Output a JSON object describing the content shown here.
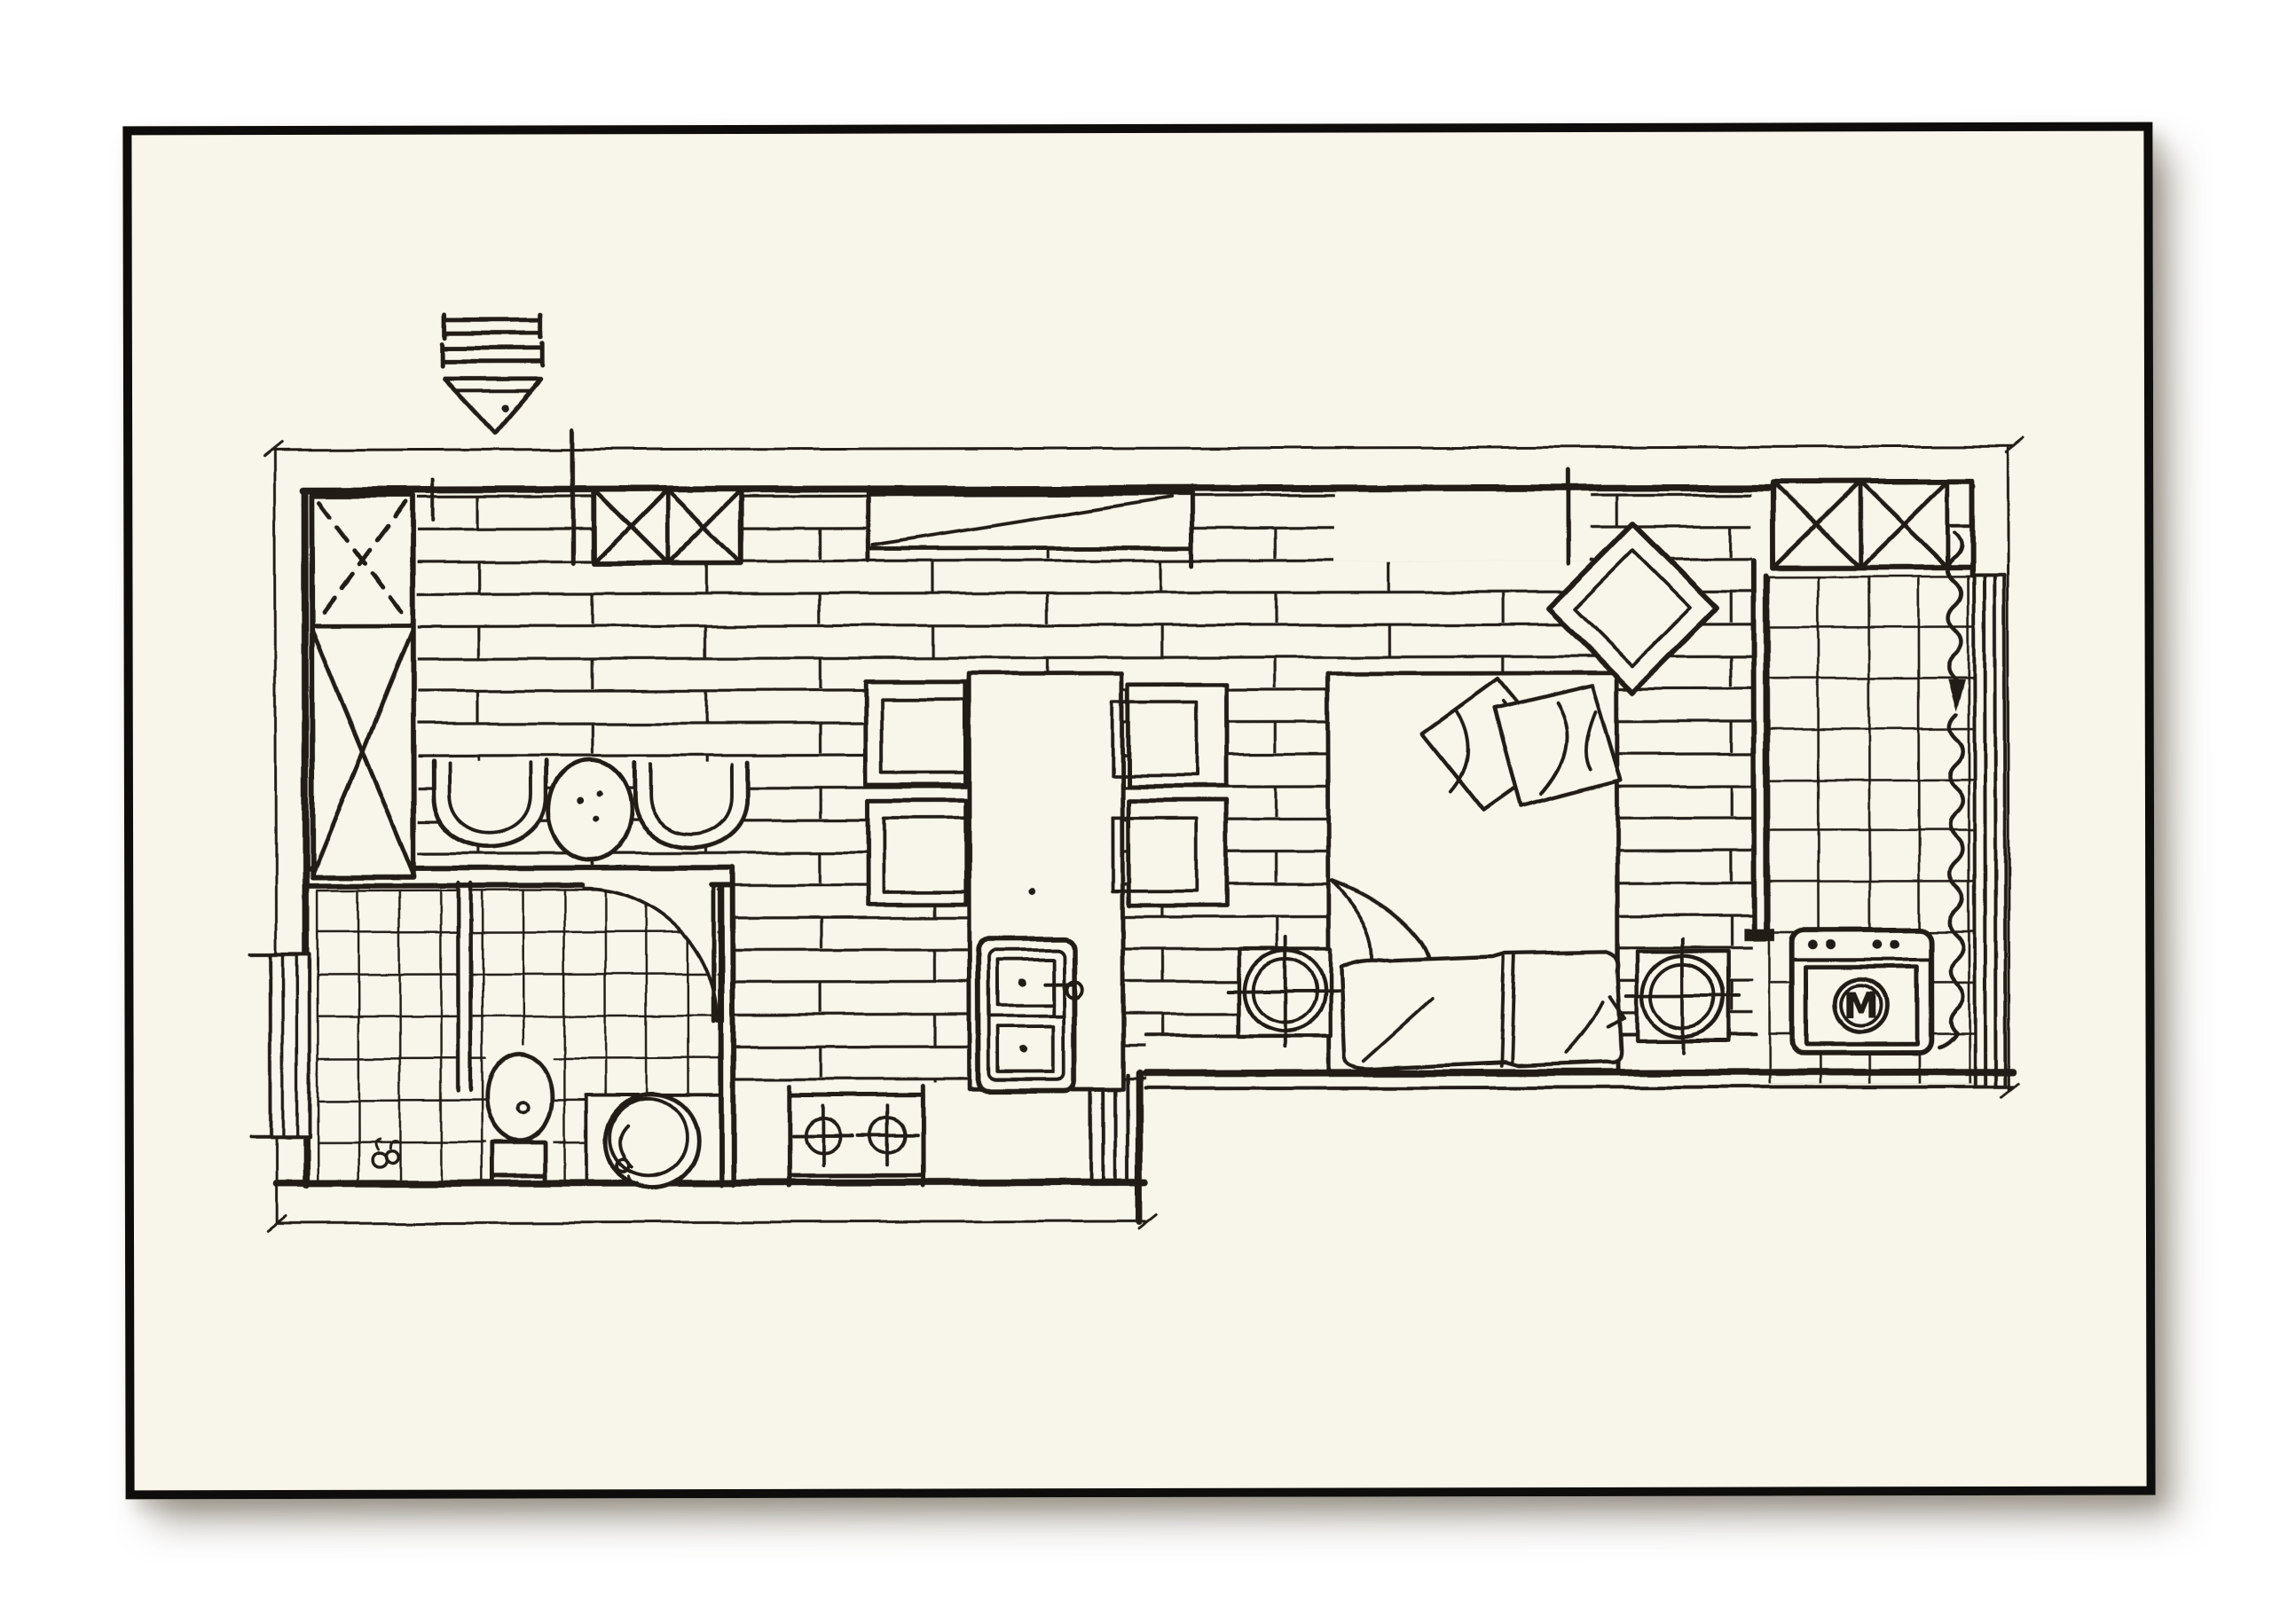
{
  "colors": {
    "ink": "#201d18",
    "paper": "#f8f6ea",
    "background": "#ffffff",
    "card_border": "#0e0d0b"
  },
  "labels": {
    "washing_machine": "M"
  },
  "plan": {
    "type": "hand-drawn apartment floor plan sketch",
    "symbols": [
      "entry-arrow",
      "dimension-lines",
      "wardrobe-x-box",
      "double-x-closet",
      "tv-console-diagonal",
      "lounge-chair",
      "round-side-table",
      "plank-floor",
      "bathroom-tile-floor",
      "bathroom-door-swing",
      "toilet",
      "wash-basin",
      "floor-drain",
      "shower-partition",
      "wall-window",
      "dining-island-table",
      "dining-chair",
      "kitchen-double-sink",
      "two-burner-stove",
      "bed",
      "pillows",
      "duvet",
      "nightstand-lamp-circle",
      "diamond-wall-decor",
      "partition-wall",
      "balcony-tile-floor",
      "washing-machine",
      "curtain-wavy-line",
      "sliding-window-tracks",
      "top-right-x-closet"
    ]
  }
}
